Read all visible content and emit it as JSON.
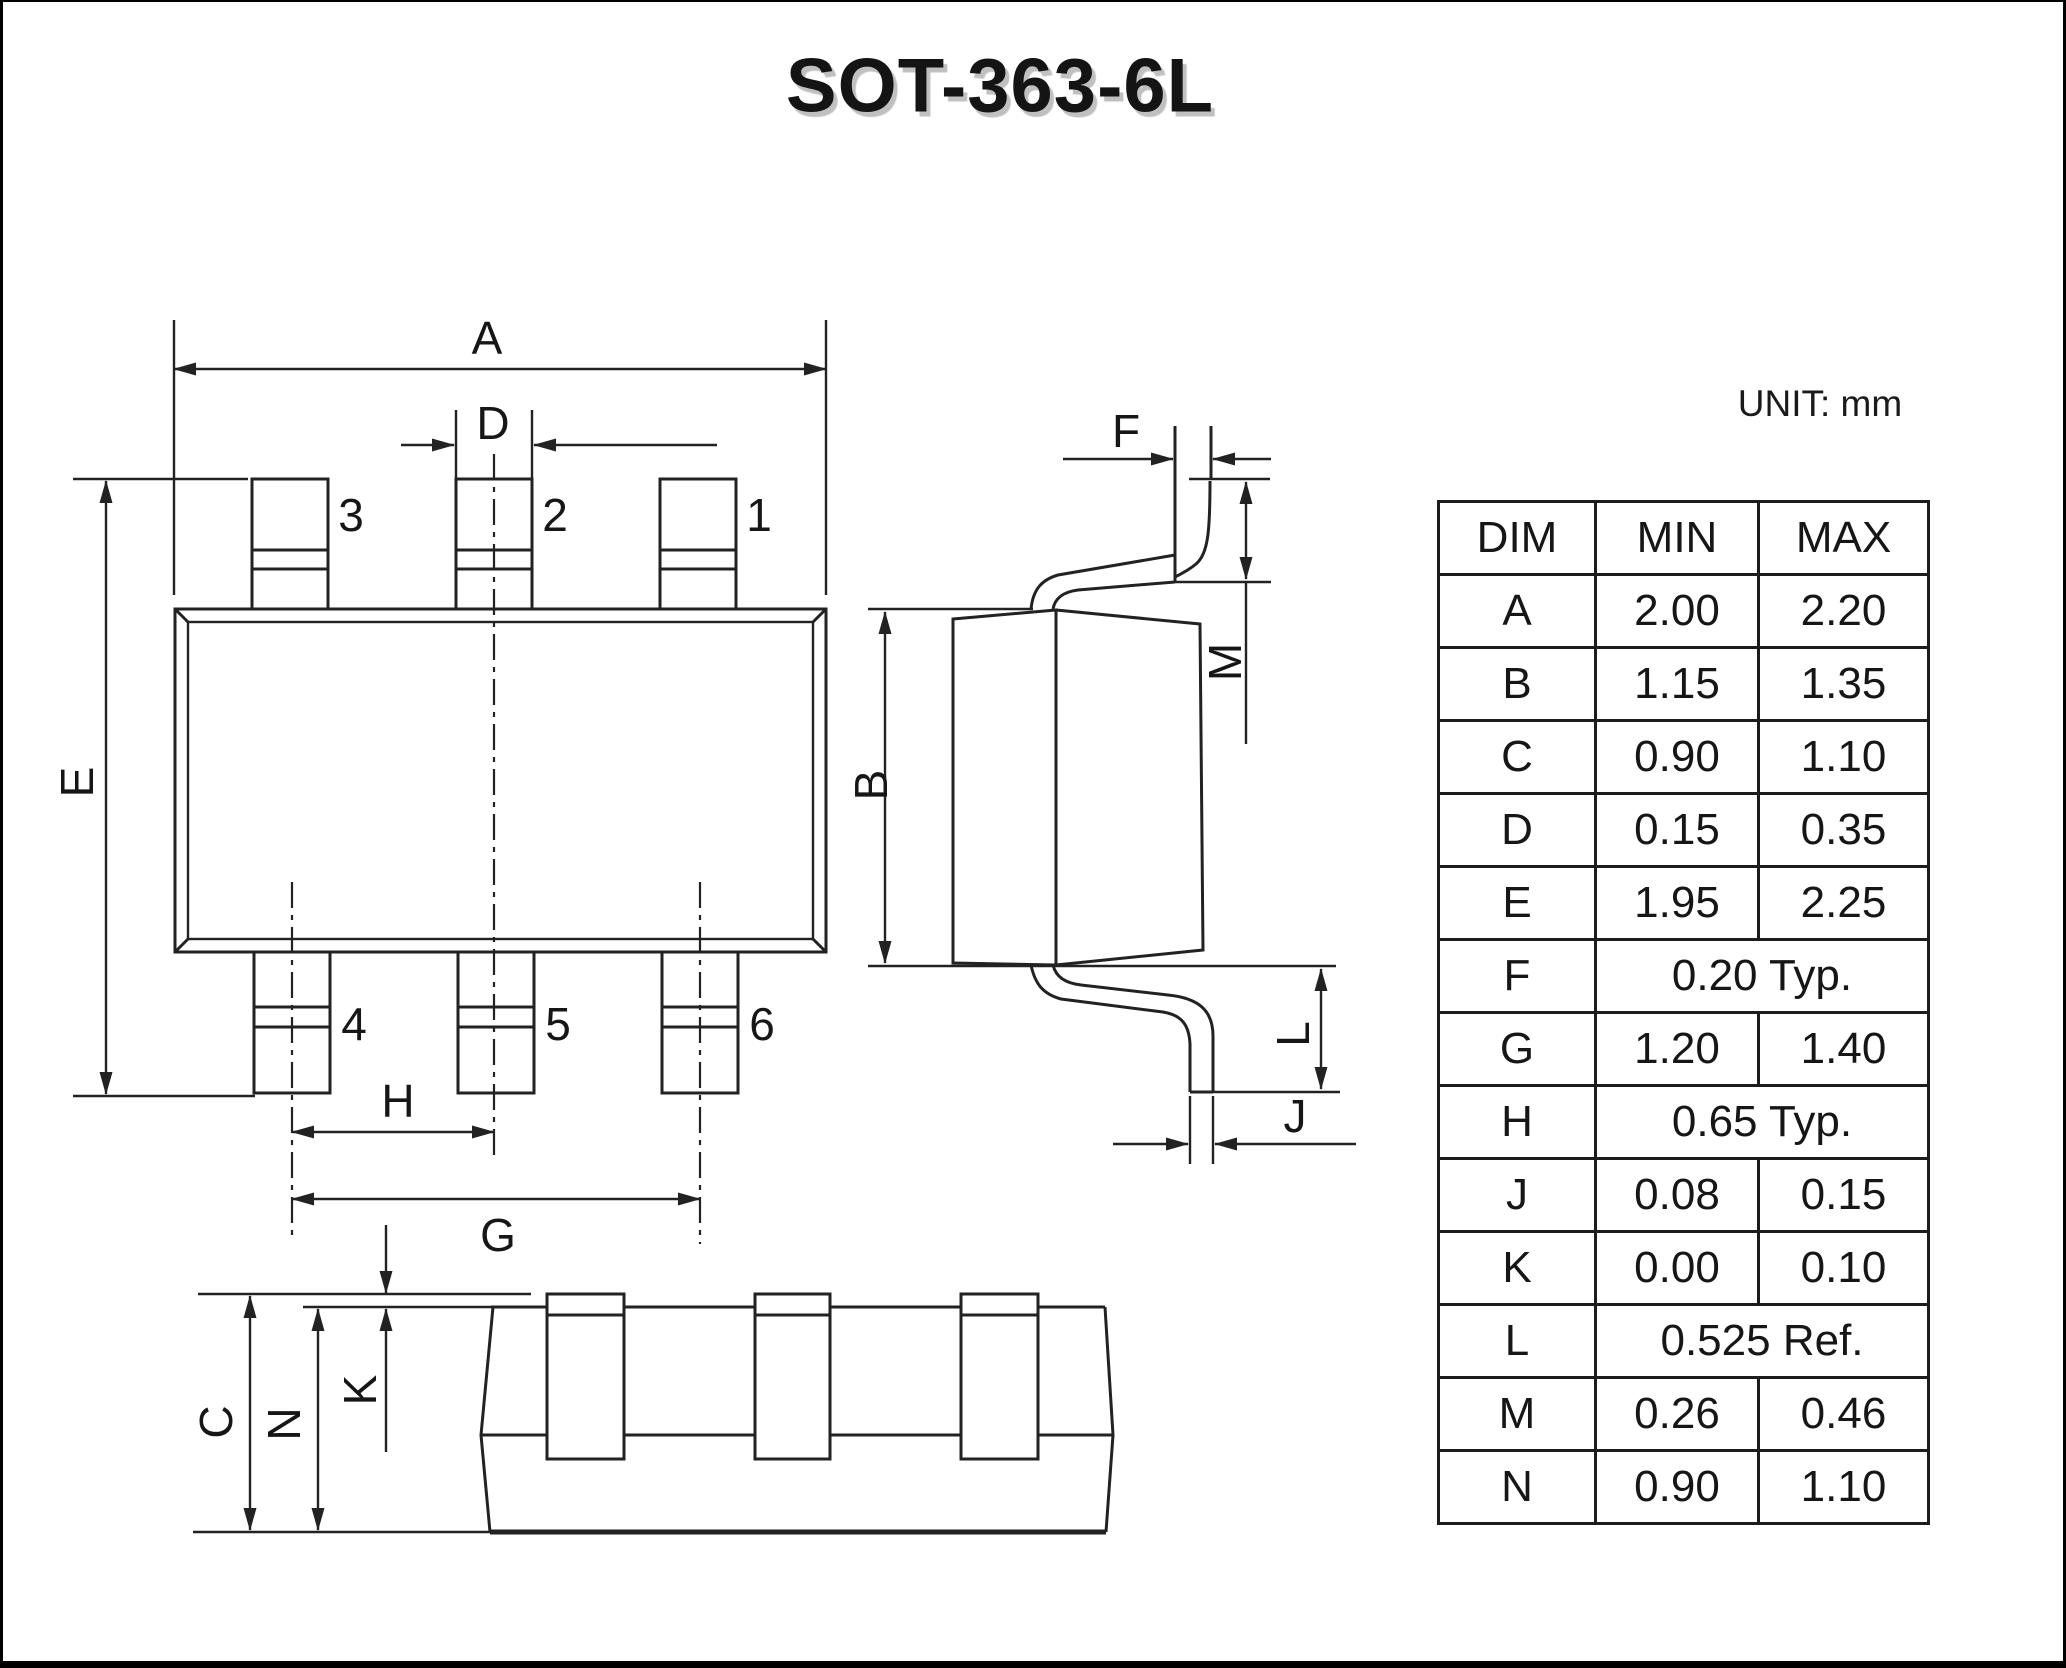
{
  "page": {
    "title": "SOT-363-6L",
    "unit_label": "UNIT: mm"
  },
  "pin_labels": {
    "p1": "1",
    "p2": "2",
    "p3": "3",
    "p4": "4",
    "p5": "5",
    "p6": "6"
  },
  "dim_labels": {
    "a": "A",
    "b": "B",
    "c": "C",
    "d": "D",
    "e": "E",
    "f": "F",
    "g": "G",
    "h": "H",
    "j": "J",
    "k": "K",
    "l": "L",
    "m": "M",
    "n": "N"
  },
  "table": {
    "headers": [
      "DIM",
      "MIN",
      "MAX"
    ],
    "rows": [
      {
        "dim": "A",
        "min": "2.00",
        "max": "2.20"
      },
      {
        "dim": "B",
        "min": "1.15",
        "max": "1.35"
      },
      {
        "dim": "C",
        "min": "0.90",
        "max": "1.10"
      },
      {
        "dim": "D",
        "min": "0.15",
        "max": "0.35"
      },
      {
        "dim": "E",
        "min": "1.95",
        "max": "2.25"
      },
      {
        "dim": "F",
        "span": "0.20 Typ."
      },
      {
        "dim": "G",
        "min": "1.20",
        "max": "1.40"
      },
      {
        "dim": "H",
        "span": "0.65 Typ."
      },
      {
        "dim": "J",
        "min": "0.08",
        "max": "0.15"
      },
      {
        "dim": "K",
        "min": "0.00",
        "max": "0.10"
      },
      {
        "dim": "L",
        "span": "0.525 Ref."
      },
      {
        "dim": "M",
        "min": "0.26",
        "max": "0.46"
      },
      {
        "dim": "N",
        "min": "0.90",
        "max": "1.10"
      }
    ]
  }
}
